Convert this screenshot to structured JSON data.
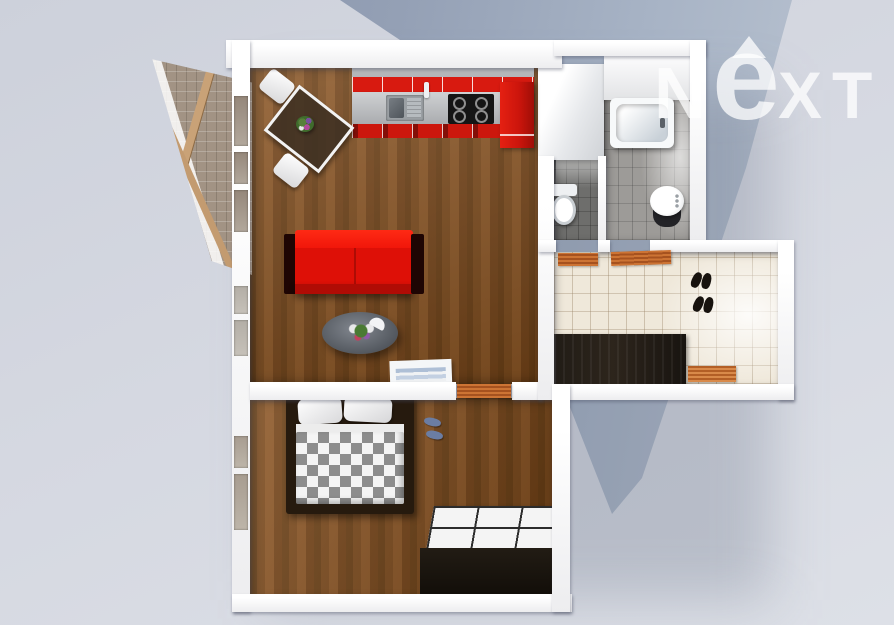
{
  "meta": {
    "description": "3D top-down architectural render of a one-bedroom apartment floor plan",
    "render_type": "3d-floorplan-top-view"
  },
  "watermark": {
    "brand": "NEXT",
    "letter_n": "N",
    "letter_e": "e",
    "letter_x": "X",
    "letter_t": "T",
    "color": "#ffffff",
    "opacity": 0.75
  },
  "palette": {
    "background": "#d5d8e1",
    "background_shape_dark": "#8591a9",
    "background_shape_light": "#b7c1cf",
    "wall_white": "#ffffff",
    "wood_floor": "#7b4a1c",
    "kitchen_red": "#d81a10",
    "sofa_red": "#de1007",
    "counter_gray": "#b9bbbd",
    "cooktop_black": "#151515",
    "bath_tile_gray": "#9d9b98",
    "wc_tile_dark": "#6e6e6c",
    "hall_tile_beige": "#efe8da",
    "wardrobe_dark": "#201a14",
    "doormat_orange": "#c2662e",
    "blanket_checker_gray": "#8d8d8d",
    "slippers_blue": "#6b7da3",
    "balcony_glass": "#a29384",
    "balcony_wood": "#c9a277"
  },
  "rooms": [
    {
      "name": "living-room-with-kitchen",
      "floor": "brown wood planks"
    },
    {
      "name": "bedroom",
      "floor": "brown wood planks"
    },
    {
      "name": "bathroom",
      "floor": "gray tile",
      "fixtures": [
        "bathtub",
        "washbasin"
      ]
    },
    {
      "name": "wc",
      "floor": "dark gray tile",
      "fixtures": [
        "toilet"
      ]
    },
    {
      "name": "hallway",
      "floor": "beige tile",
      "fixtures": [
        "dark wardrobe",
        "two shoe pairs",
        "doormats"
      ]
    },
    {
      "name": "balcony",
      "floor": "glazed structure with wooden planks"
    }
  ],
  "furniture": {
    "kitchen": [
      "red upper cabinets",
      "gray countertop",
      "double sink with faucet",
      "black cooktop with 4 burners",
      "red fridge unit",
      "red base cabinets"
    ],
    "living": [
      "glass dining table with flowers",
      "two white chairs",
      "red sofa with dark armrests",
      "oval glass coffee table with plant and cup",
      "white sideboard with blue linens",
      "curved dark shelf"
    ],
    "bedroom": [
      "double bed with gray-white checkered blanket and two pillows",
      "blue slippers",
      "dark wardrobe with white paneled top"
    ],
    "doormats": [
      "living-bedroom door mat",
      "wc door mat",
      "bathroom door mat",
      "entry door mat"
    ]
  }
}
